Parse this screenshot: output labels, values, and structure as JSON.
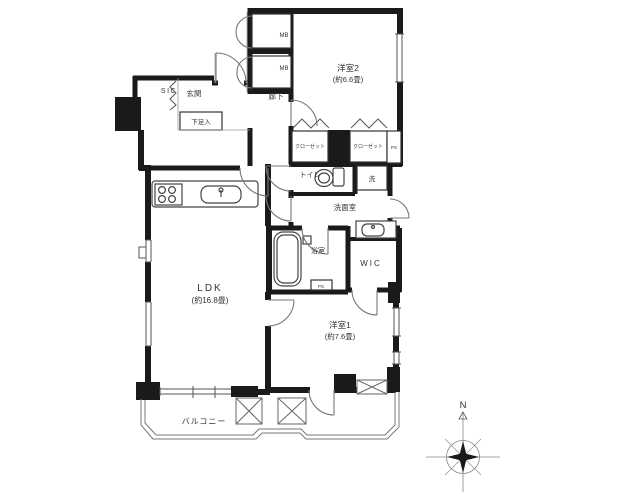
{
  "floor_plan": {
    "rooms": {
      "yoshitsu2": {
        "label": "洋室2",
        "area": "(約6.6畳)"
      },
      "yoshitsu1": {
        "label": "洋室1",
        "area": "(約7.6畳)"
      },
      "ldk": {
        "label": "LDK",
        "area": "(約16.8畳)"
      },
      "balcony": {
        "label": "バルコニー"
      },
      "genkan": {
        "label": "玄関"
      },
      "sic": {
        "label": "SIC"
      },
      "shoes": {
        "label": "下足入"
      },
      "hallway": {
        "label": "廊下"
      },
      "toilet": {
        "label": "トイレ"
      },
      "washroom": {
        "label": "洗面室"
      },
      "laundry": {
        "label": "洗"
      },
      "bathroom": {
        "label": "浴室"
      },
      "wic": {
        "label": "WIC"
      },
      "closet": {
        "label": "クローゼット"
      },
      "meter_box": {
        "label": "MB"
      },
      "pipe_space": {
        "label": "PS"
      }
    },
    "compass": {
      "north": "N"
    },
    "colors": {
      "wall": "#1a1a1a",
      "thin_line": "#555555",
      "light_line": "#888888",
      "text": "#333333",
      "background": "#ffffff"
    }
  }
}
